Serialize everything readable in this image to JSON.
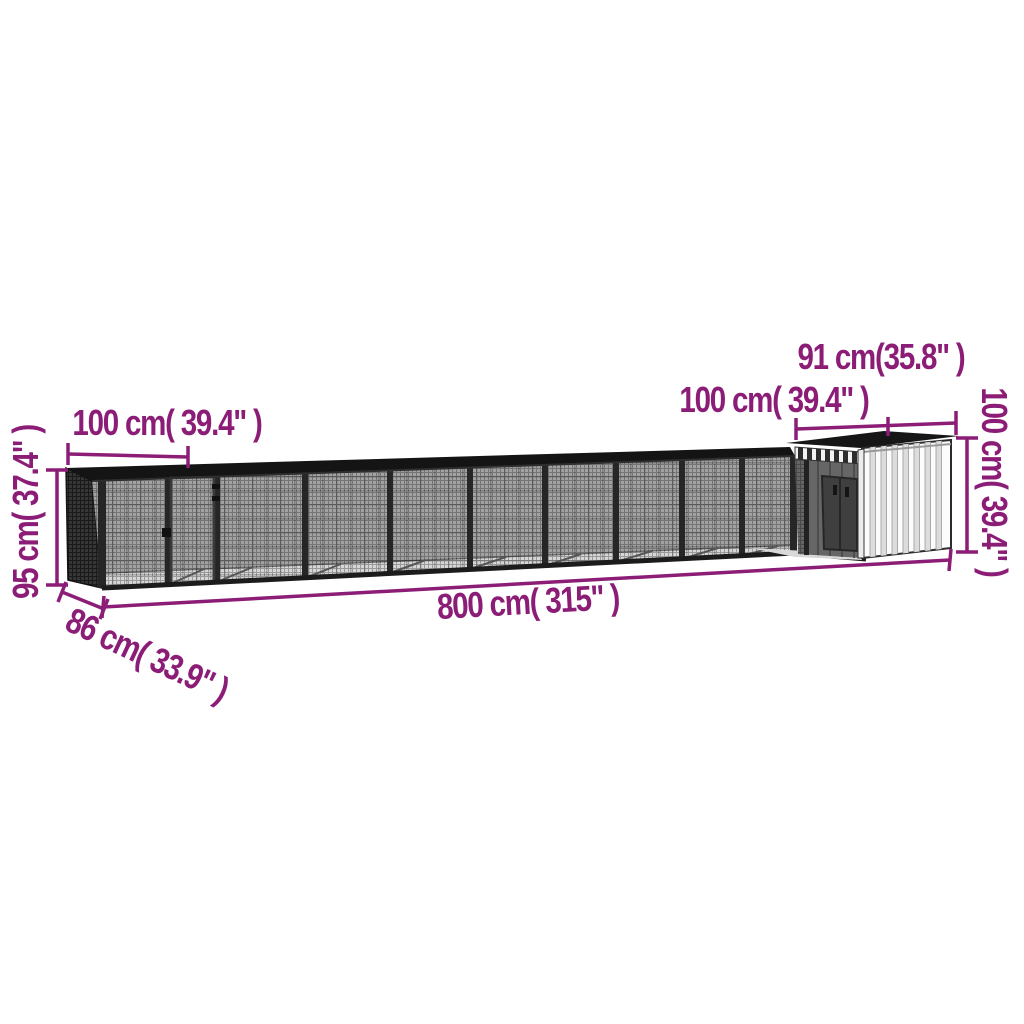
{
  "colors": {
    "accent": "#8C1D77",
    "background": "#FFFFFF"
  },
  "diagram": {
    "kind": "product-dimensions"
  },
  "dimensions": {
    "run_roof_width": {
      "text": "100 cm( 39.4\" )"
    },
    "run_height": {
      "text": "95 cm( 37.4\" )"
    },
    "run_depth": {
      "text": "86 cm( 33.9\" )"
    },
    "total_length": {
      "text": "800 cm( 315\" )"
    },
    "shed_width": {
      "text": "91 cm(35.8\" )"
    },
    "shed_roof_depth": {
      "text": "100 cm( 39.4\" )"
    },
    "shed_height": {
      "text": "100 cm( 39.4\" )"
    }
  }
}
